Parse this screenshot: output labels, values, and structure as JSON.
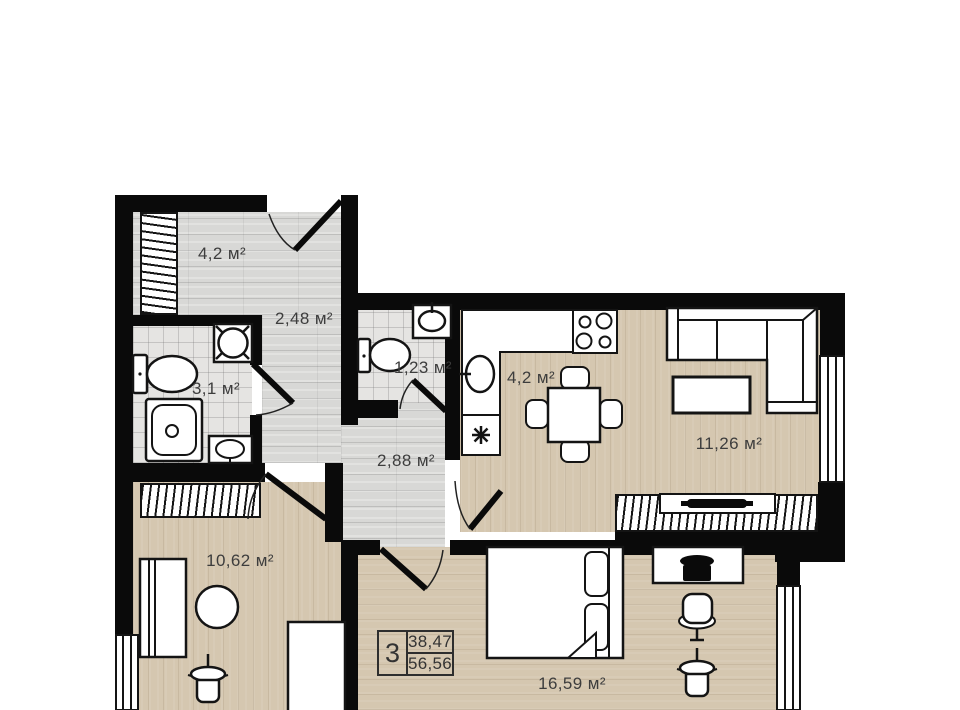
{
  "plan": {
    "title": "apartment-floor-plan",
    "rooms": {
      "wardrobe_hall": {
        "area": "4,2 м²"
      },
      "entry_hall": {
        "area": "2,48 м²"
      },
      "bathroom": {
        "area": "3,1 м²"
      },
      "wc": {
        "area": "1,23 м²"
      },
      "kitchen": {
        "area": "4,2 м²"
      },
      "living_room": {
        "area": "11,26 м²"
      },
      "inner_hall": {
        "area": "2,88 м²"
      },
      "room_small": {
        "area": "10,62 м²"
      },
      "bedroom": {
        "area": "16,59 м²"
      }
    },
    "info_badge": {
      "rooms_count": "3",
      "living_area": "38,47",
      "total_area": "56,56"
    },
    "colors": {
      "wall": "#0a0a0a",
      "line": "#141414",
      "wood": "#d5c7b0",
      "lam": "#d8d8d6",
      "tile": "#e5e4e2",
      "label": "#3d3d3d"
    }
  }
}
